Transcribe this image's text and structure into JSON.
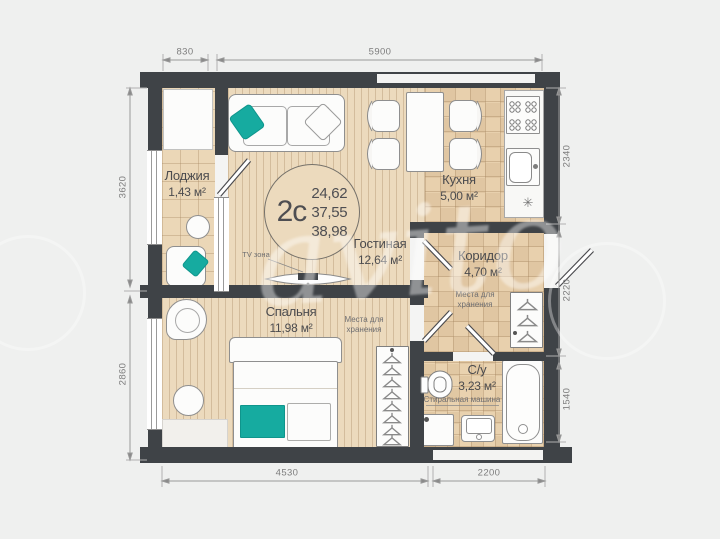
{
  "watermark": {
    "text": "avito"
  },
  "unit": {
    "type_label": "2с",
    "area_values": [
      "24,62",
      "37,55",
      "38,98"
    ]
  },
  "rooms": [
    {
      "name": "Лоджия",
      "area": "1,43 м²"
    },
    {
      "name": "Гостиная",
      "area": "12,64 м²"
    },
    {
      "name": "Кухня",
      "area": "5,00 м²"
    },
    {
      "name": "Коридор",
      "area": "4,70 м²"
    },
    {
      "name": "Спальня",
      "area": "11,98 м²"
    },
    {
      "name": "С/у",
      "area": "3,23 м²"
    }
  ],
  "annotations": {
    "tv_zone": "TV зона",
    "storage_corridor": "Места для хранения",
    "storage_bedroom": "Места для хранения",
    "washing_machine": "Стиральная машина"
  },
  "dimensions": {
    "top": [
      "830",
      "5900"
    ],
    "left": [
      "3620",
      "2860"
    ],
    "right": [
      "2340",
      "2220",
      "1540"
    ],
    "bottom": [
      "4530",
      "2200"
    ]
  },
  "icons": {
    "kitchen_vent": "✳"
  },
  "colors": {
    "wall": "#3f4347",
    "floor_plank": "#ecdabd",
    "accent_teal": "#16aba0",
    "background": "#eff0ef"
  }
}
